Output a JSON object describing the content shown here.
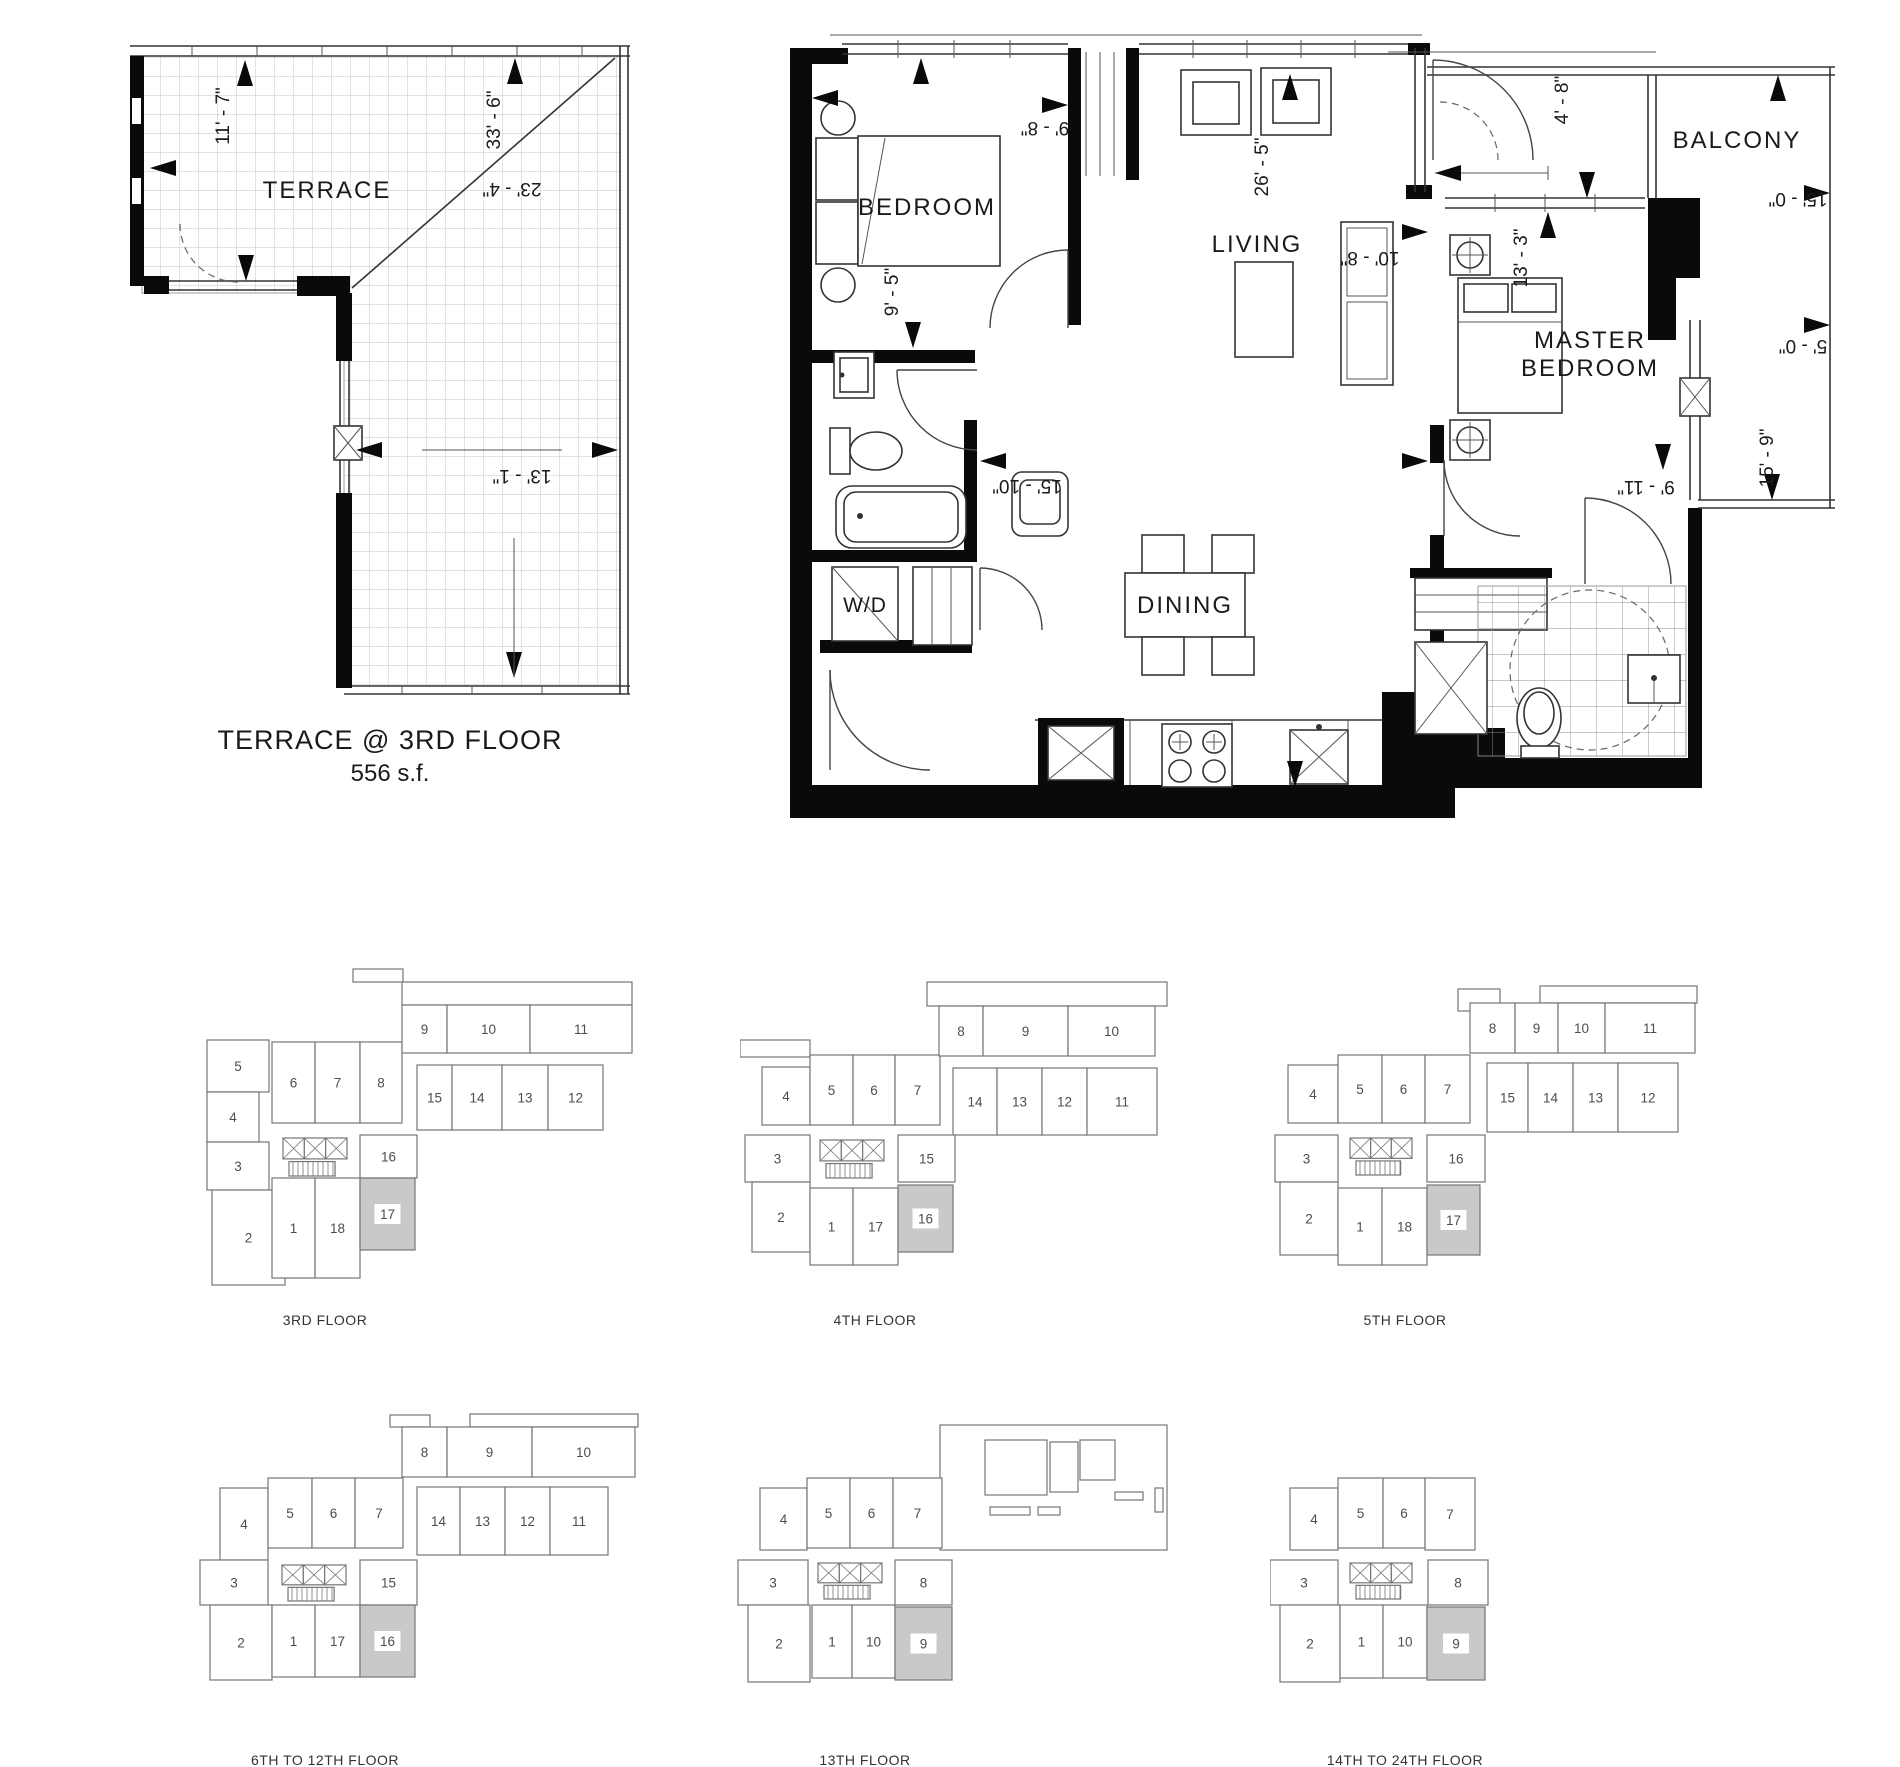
{
  "terrace_plan": {
    "room_label": "TERRACE",
    "caption_line1": "TERRACE @ 3RD FLOOR",
    "caption_line2": "556 s.f.",
    "dims": {
      "left_vertical": "11' - 7\"",
      "diagonal": "33' - 6\"",
      "top_width": "23' - 4\"",
      "lower_width": "13' - 1\""
    }
  },
  "main_plan": {
    "rooms": {
      "bedroom": "BEDROOM",
      "living": "LIVING",
      "master_line1": "MASTER",
      "master_line2": "BEDROOM",
      "balcony": "BALCONY",
      "dining": "DINING",
      "laundry": "W/D"
    },
    "dims": {
      "bedroom_width": "9' - 8\"",
      "bedroom_depth": "9' - 5\"",
      "living_length": "26' - 5\"",
      "kitchen_width": "10' - 8\"",
      "entry_width": "4' - 8\"",
      "master_width": "13' - 3\"",
      "master_depth": "9' - 11\"",
      "balcony_top": "15' - 0\"",
      "balcony_mid": "5' - 0\"",
      "balcony_right": "15' - 9\"",
      "dining_width": "15' - 10\""
    }
  },
  "keyplans": [
    {
      "label": "3RD FLOOR",
      "highlight": "17",
      "core": {
        "x": 93,
        "y": 178,
        "w": 64,
        "h": 38
      },
      "extra_rects": [
        [
          163,
          9,
          50,
          13
        ],
        [
          212,
          22,
          230,
          23
        ]
      ],
      "units": [
        {
          "n": "5",
          "x": 17,
          "y": 80,
          "w": 62,
          "h": 52
        },
        {
          "n": "4",
          "x": 17,
          "y": 132,
          "w": 52,
          "h": 50
        },
        {
          "n": "3",
          "x": 17,
          "y": 182,
          "w": 62,
          "h": 48
        },
        {
          "n": "2",
          "x": 22,
          "y": 230,
          "w": 73,
          "h": 95
        },
        {
          "n": "6",
          "x": 82,
          "y": 82,
          "w": 43,
          "h": 81
        },
        {
          "n": "7",
          "x": 125,
          "y": 82,
          "w": 45,
          "h": 81
        },
        {
          "n": "8",
          "x": 170,
          "y": 82,
          "w": 42,
          "h": 81
        },
        {
          "n": "9",
          "x": 212,
          "y": 45,
          "w": 45,
          "h": 48
        },
        {
          "n": "10",
          "x": 257,
          "y": 45,
          "w": 83,
          "h": 48
        },
        {
          "n": "11",
          "x": 340,
          "y": 45,
          "w": 102,
          "h": 48
        },
        {
          "n": "15",
          "x": 227,
          "y": 105,
          "w": 35,
          "h": 65
        },
        {
          "n": "14",
          "x": 262,
          "y": 105,
          "w": 50,
          "h": 65
        },
        {
          "n": "13",
          "x": 312,
          "y": 105,
          "w": 46,
          "h": 65
        },
        {
          "n": "12",
          "x": 358,
          "y": 105,
          "w": 55,
          "h": 65
        },
        {
          "n": "16",
          "x": 170,
          "y": 175,
          "w": 57,
          "h": 43
        },
        {
          "n": "1",
          "x": 82,
          "y": 218,
          "w": 43,
          "h": 100
        },
        {
          "n": "18",
          "x": 125,
          "y": 218,
          "w": 45,
          "h": 100
        },
        {
          "n": "17",
          "x": 170,
          "y": 218,
          "w": 55,
          "h": 72
        }
      ]
    },
    {
      "label": "4TH FLOOR",
      "highlight": "16",
      "core": {
        "x": 80,
        "y": 180,
        "w": 64,
        "h": 38
      },
      "extra_rects": [
        [
          187,
          22,
          240,
          24
        ],
        [
          0,
          80,
          70,
          17
        ]
      ],
      "units": [
        {
          "n": "4",
          "x": 22,
          "y": 107,
          "w": 48,
          "h": 58
        },
        {
          "n": "3",
          "x": 5,
          "y": 175,
          "w": 65,
          "h": 47
        },
        {
          "n": "2",
          "x": 12,
          "y": 222,
          "w": 58,
          "h": 70
        },
        {
          "n": "5",
          "x": 70,
          "y": 95,
          "w": 43,
          "h": 70
        },
        {
          "n": "6",
          "x": 113,
          "y": 95,
          "w": 42,
          "h": 70
        },
        {
          "n": "7",
          "x": 155,
          "y": 95,
          "w": 45,
          "h": 70
        },
        {
          "n": "8",
          "x": 199,
          "y": 46,
          "w": 44,
          "h": 50
        },
        {
          "n": "9",
          "x": 243,
          "y": 46,
          "w": 85,
          "h": 50
        },
        {
          "n": "10",
          "x": 328,
          "y": 46,
          "w": 87,
          "h": 50
        },
        {
          "n": "14",
          "x": 213,
          "y": 108,
          "w": 44,
          "h": 67
        },
        {
          "n": "13",
          "x": 257,
          "y": 108,
          "w": 45,
          "h": 67
        },
        {
          "n": "12",
          "x": 302,
          "y": 108,
          "w": 45,
          "h": 67
        },
        {
          "n": "11",
          "x": 347,
          "y": 108,
          "w": 70,
          "h": 67
        },
        {
          "n": "15",
          "x": 158,
          "y": 175,
          "w": 57,
          "h": 47
        },
        {
          "n": "1",
          "x": 70,
          "y": 228,
          "w": 43,
          "h": 77
        },
        {
          "n": "17",
          "x": 113,
          "y": 228,
          "w": 45,
          "h": 77
        },
        {
          "n": "16",
          "x": 158,
          "y": 225,
          "w": 55,
          "h": 67
        }
      ]
    },
    {
      "label": "5TH FLOOR",
      "highlight": "17",
      "core": {
        "x": 80,
        "y": 178,
        "w": 62,
        "h": 37
      },
      "extra_rects": [
        [
          188,
          29,
          42,
          22
        ],
        [
          270,
          26,
          157,
          17
        ]
      ],
      "units": [
        {
          "n": "4",
          "x": 18,
          "y": 105,
          "w": 50,
          "h": 58
        },
        {
          "n": "3",
          "x": 5,
          "y": 175,
          "w": 63,
          "h": 47
        },
        {
          "n": "2",
          "x": 10,
          "y": 222,
          "w": 58,
          "h": 73
        },
        {
          "n": "5",
          "x": 68,
          "y": 95,
          "w": 44,
          "h": 68
        },
        {
          "n": "6",
          "x": 112,
          "y": 95,
          "w": 43,
          "h": 68
        },
        {
          "n": "7",
          "x": 155,
          "y": 95,
          "w": 45,
          "h": 68
        },
        {
          "n": "8",
          "x": 200,
          "y": 43,
          "w": 45,
          "h": 50
        },
        {
          "n": "9",
          "x": 245,
          "y": 43,
          "w": 43,
          "h": 50
        },
        {
          "n": "10",
          "x": 288,
          "y": 43,
          "w": 47,
          "h": 50
        },
        {
          "n": "11",
          "x": 335,
          "y": 43,
          "w": 90,
          "h": 50
        },
        {
          "n": "15",
          "x": 217,
          "y": 103,
          "w": 41,
          "h": 69
        },
        {
          "n": "14",
          "x": 258,
          "y": 103,
          "w": 45,
          "h": 69
        },
        {
          "n": "13",
          "x": 303,
          "y": 103,
          "w": 45,
          "h": 69
        },
        {
          "n": "12",
          "x": 348,
          "y": 103,
          "w": 60,
          "h": 69
        },
        {
          "n": "16",
          "x": 157,
          "y": 175,
          "w": 58,
          "h": 47
        },
        {
          "n": "1",
          "x": 68,
          "y": 228,
          "w": 44,
          "h": 77
        },
        {
          "n": "18",
          "x": 112,
          "y": 228,
          "w": 45,
          "h": 77
        },
        {
          "n": "17",
          "x": 157,
          "y": 225,
          "w": 53,
          "h": 70
        }
      ]
    },
    {
      "label": "6TH TO 12TH FLOOR",
      "highlight": "16",
      "core": {
        "x": 92,
        "y": 165,
        "w": 64,
        "h": 36
      },
      "extra_rects": [
        [
          200,
          15,
          40,
          12
        ],
        [
          280,
          14,
          168,
          13
        ]
      ],
      "units": [
        {
          "n": "4",
          "x": 30,
          "y": 88,
          "w": 48,
          "h": 72
        },
        {
          "n": "3",
          "x": 10,
          "y": 160,
          "w": 68,
          "h": 45
        },
        {
          "n": "2",
          "x": 20,
          "y": 205,
          "w": 62,
          "h": 75
        },
        {
          "n": "5",
          "x": 78,
          "y": 78,
          "w": 44,
          "h": 70
        },
        {
          "n": "6",
          "x": 122,
          "y": 78,
          "w": 43,
          "h": 70
        },
        {
          "n": "7",
          "x": 165,
          "y": 78,
          "w": 48,
          "h": 70
        },
        {
          "n": "8",
          "x": 212,
          "y": 27,
          "w": 45,
          "h": 50
        },
        {
          "n": "9",
          "x": 257,
          "y": 27,
          "w": 85,
          "h": 50
        },
        {
          "n": "10",
          "x": 342,
          "y": 27,
          "w": 103,
          "h": 50
        },
        {
          "n": "14",
          "x": 227,
          "y": 87,
          "w": 43,
          "h": 68
        },
        {
          "n": "13",
          "x": 270,
          "y": 87,
          "w": 45,
          "h": 68
        },
        {
          "n": "12",
          "x": 315,
          "y": 87,
          "w": 45,
          "h": 68
        },
        {
          "n": "11",
          "x": 360,
          "y": 87,
          "w": 58,
          "h": 68
        },
        {
          "n": "15",
          "x": 170,
          "y": 160,
          "w": 57,
          "h": 45
        },
        {
          "n": "1",
          "x": 82,
          "y": 205,
          "w": 43,
          "h": 72
        },
        {
          "n": "17",
          "x": 125,
          "y": 205,
          "w": 45,
          "h": 72
        },
        {
          "n": "16",
          "x": 170,
          "y": 205,
          "w": 55,
          "h": 72
        }
      ]
    },
    {
      "label": "13TH FLOOR",
      "highlight": "9",
      "core": {
        "x": 88,
        "y": 163,
        "w": 64,
        "h": 36
      },
      "extra_rects": [
        [
          210,
          25,
          227,
          125
        ],
        [
          255,
          40,
          62,
          55
        ],
        [
          320,
          42,
          28,
          50
        ],
        [
          350,
          40,
          35,
          40
        ],
        [
          260,
          107,
          40,
          8
        ],
        [
          308,
          107,
          22,
          8
        ],
        [
          385,
          92,
          28,
          8
        ],
        [
          425,
          88,
          8,
          24
        ]
      ],
      "units": [
        {
          "n": "4",
          "x": 30,
          "y": 88,
          "w": 47,
          "h": 62
        },
        {
          "n": "3",
          "x": 8,
          "y": 160,
          "w": 70,
          "h": 45
        },
        {
          "n": "2",
          "x": 18,
          "y": 205,
          "w": 62,
          "h": 77
        },
        {
          "n": "5",
          "x": 77,
          "y": 78,
          "w": 43,
          "h": 70
        },
        {
          "n": "6",
          "x": 120,
          "y": 78,
          "w": 43,
          "h": 70
        },
        {
          "n": "7",
          "x": 163,
          "y": 78,
          "w": 49,
          "h": 70
        },
        {
          "n": "8",
          "x": 165,
          "y": 160,
          "w": 57,
          "h": 45
        },
        {
          "n": "1",
          "x": 82,
          "y": 205,
          "w": 40,
          "h": 73
        },
        {
          "n": "10",
          "x": 122,
          "y": 205,
          "w": 43,
          "h": 73
        },
        {
          "n": "9",
          "x": 165,
          "y": 207,
          "w": 57,
          "h": 73
        }
      ]
    },
    {
      "label": "14TH TO 24TH FLOOR",
      "highlight": "9",
      "core": {
        "x": 80,
        "y": 163,
        "w": 62,
        "h": 36
      },
      "extra_rects": [],
      "units": [
        {
          "n": "4",
          "x": 20,
          "y": 88,
          "w": 48,
          "h": 62
        },
        {
          "n": "3",
          "x": 0,
          "y": 160,
          "w": 68,
          "h": 45
        },
        {
          "n": "2",
          "x": 10,
          "y": 205,
          "w": 60,
          "h": 77
        },
        {
          "n": "5",
          "x": 68,
          "y": 78,
          "w": 45,
          "h": 70
        },
        {
          "n": "6",
          "x": 113,
          "y": 78,
          "w": 42,
          "h": 70
        },
        {
          "n": "7",
          "x": 155,
          "y": 78,
          "w": 50,
          "h": 72
        },
        {
          "n": "8",
          "x": 158,
          "y": 160,
          "w": 60,
          "h": 45
        },
        {
          "n": "1",
          "x": 70,
          "y": 205,
          "w": 43,
          "h": 73
        },
        {
          "n": "10",
          "x": 113,
          "y": 205,
          "w": 44,
          "h": 73
        },
        {
          "n": "9",
          "x": 157,
          "y": 207,
          "w": 58,
          "h": 73
        }
      ]
    }
  ]
}
